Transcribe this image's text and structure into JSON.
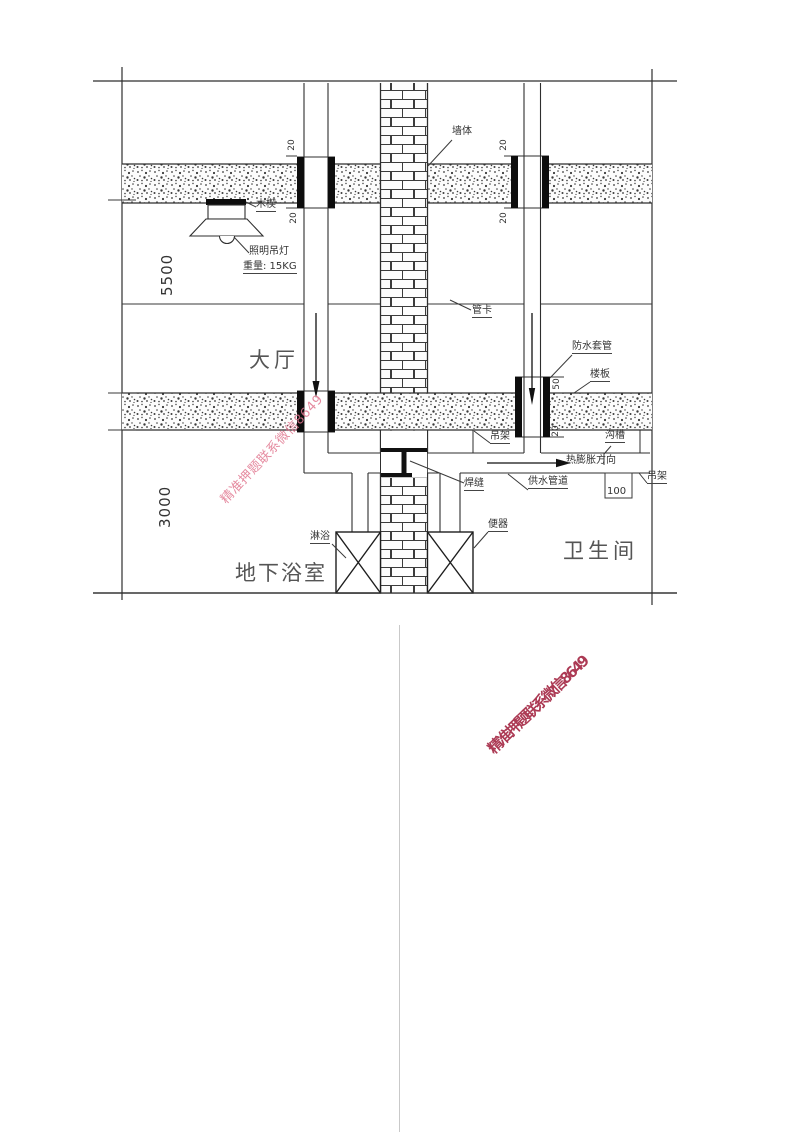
{
  "drawing": {
    "rooms": {
      "hall": "大厅",
      "basement_bath": "地下浴室",
      "bathroom": "卫生间"
    },
    "labels": {
      "wall": "墙体",
      "wood_wedge": "木楔",
      "lamp": "照明吊灯",
      "lamp_weight": "重量: 15KG",
      "pipe_clamp": "管卡",
      "waterproof_sleeve": "防水套管",
      "floor_slab": "楼板",
      "hanger_left": "吊架",
      "groove": "沟槽",
      "thermal_direction": "热膨胀方向",
      "weld_seam": "焊缝",
      "supply_pipe": "供水管道",
      "hanger_right": "吊架",
      "toilet": "便器",
      "shower": "淋浴"
    },
    "dimensions": {
      "hall_height": "5500",
      "basement_height": "3000",
      "left_sleeve_above": "20",
      "left_sleeve_below": "20",
      "right_sleeve_above": "20",
      "right_sleeve_below": "20",
      "wp_sleeve_above": "50",
      "wp_sleeve_below": "20",
      "groove_width": "100"
    }
  },
  "watermark": {
    "text": "精准押题联系微信8649",
    "light_color": "#e0768e",
    "dark_color": "#ac3a54"
  }
}
